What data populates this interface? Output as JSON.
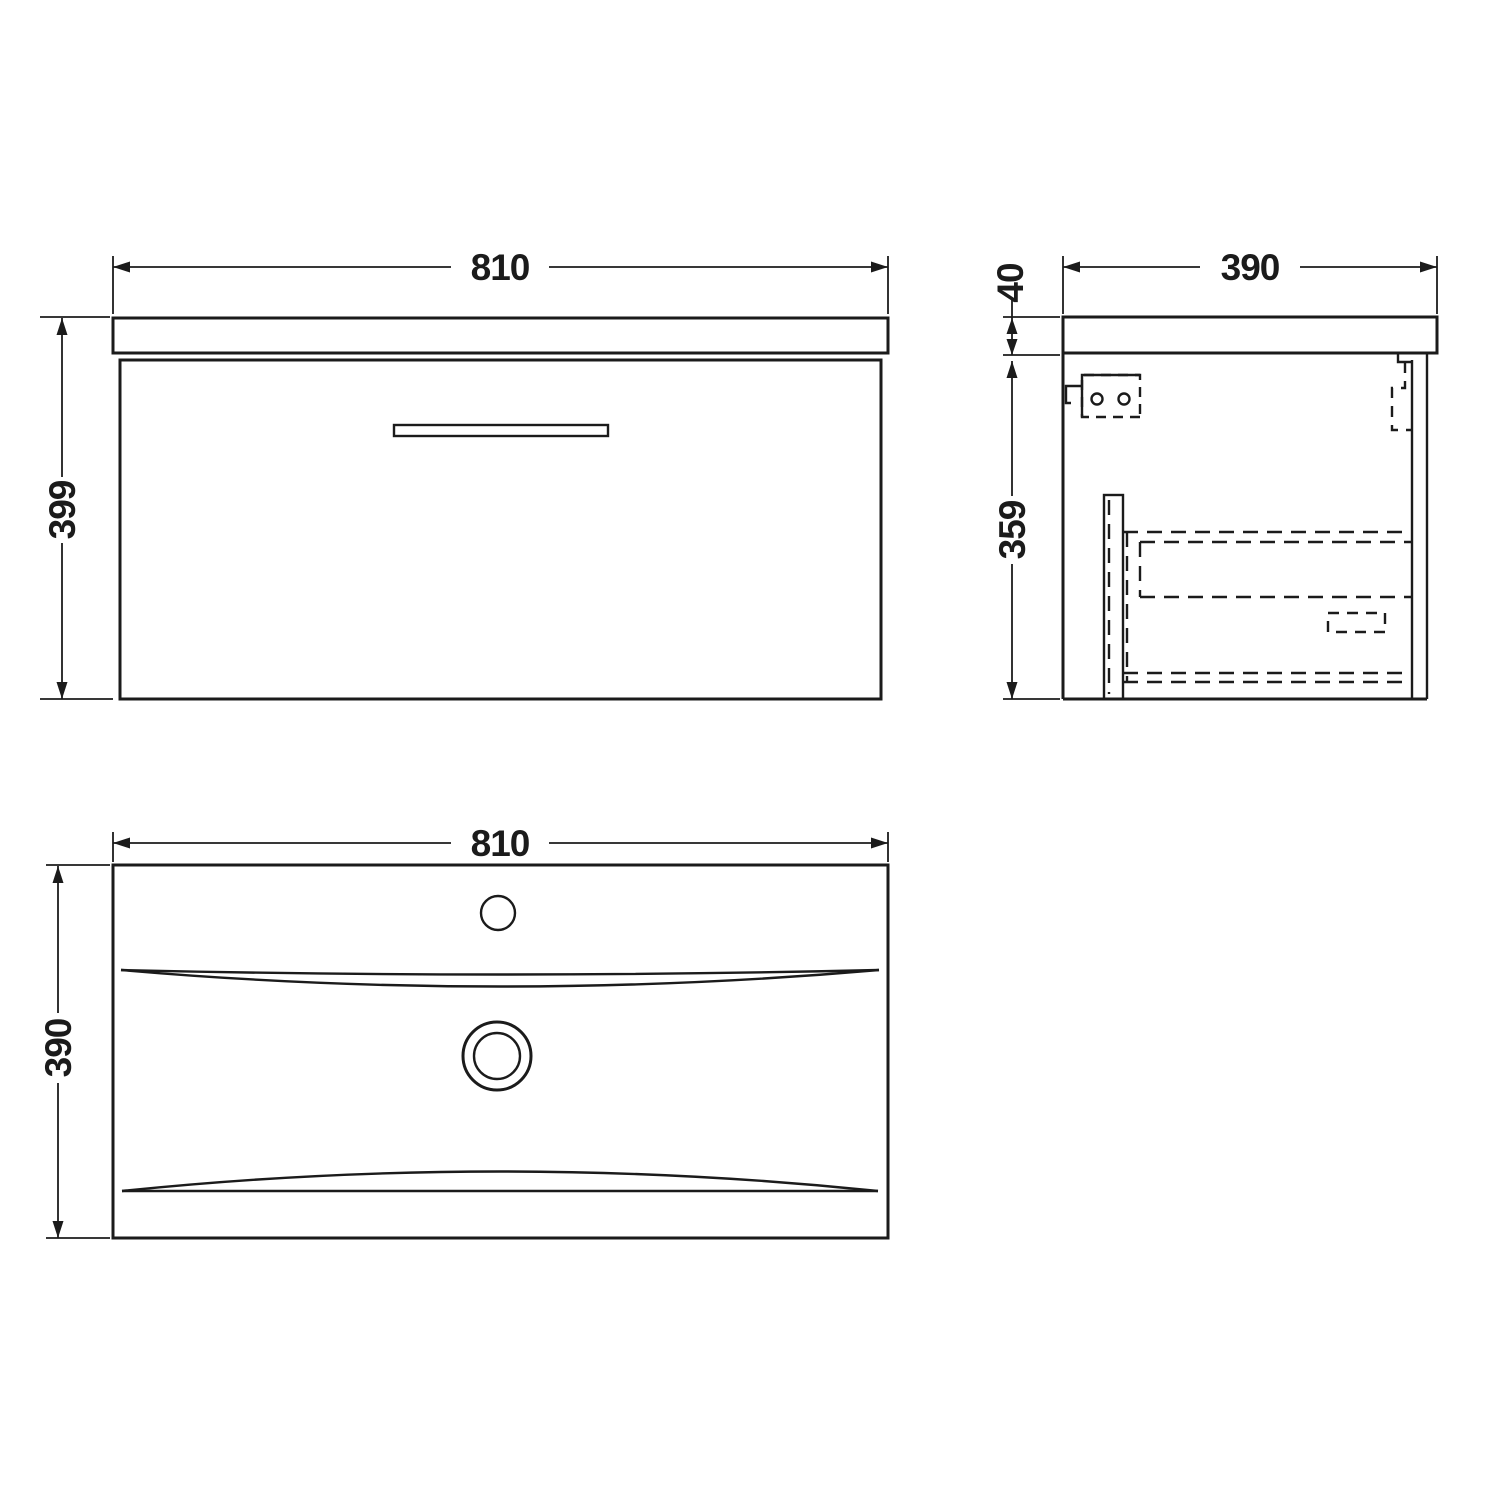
{
  "page": {
    "background": "#ffffff",
    "line_color": "#1b1b1b",
    "description": "Technical dimension drawing of wall-hung vanity unit with basin: front elevation, side section and basin plan view"
  },
  "views": {
    "front": {
      "title": "front-elevation",
      "width_mm": "810",
      "height_mm": "399"
    },
    "side": {
      "title": "side-section",
      "depth_mm": "390",
      "top_thickness_mm": "40",
      "body_height_mm": "359"
    },
    "plan": {
      "title": "basin-plan",
      "width_mm": "810",
      "depth_mm": "390"
    }
  }
}
